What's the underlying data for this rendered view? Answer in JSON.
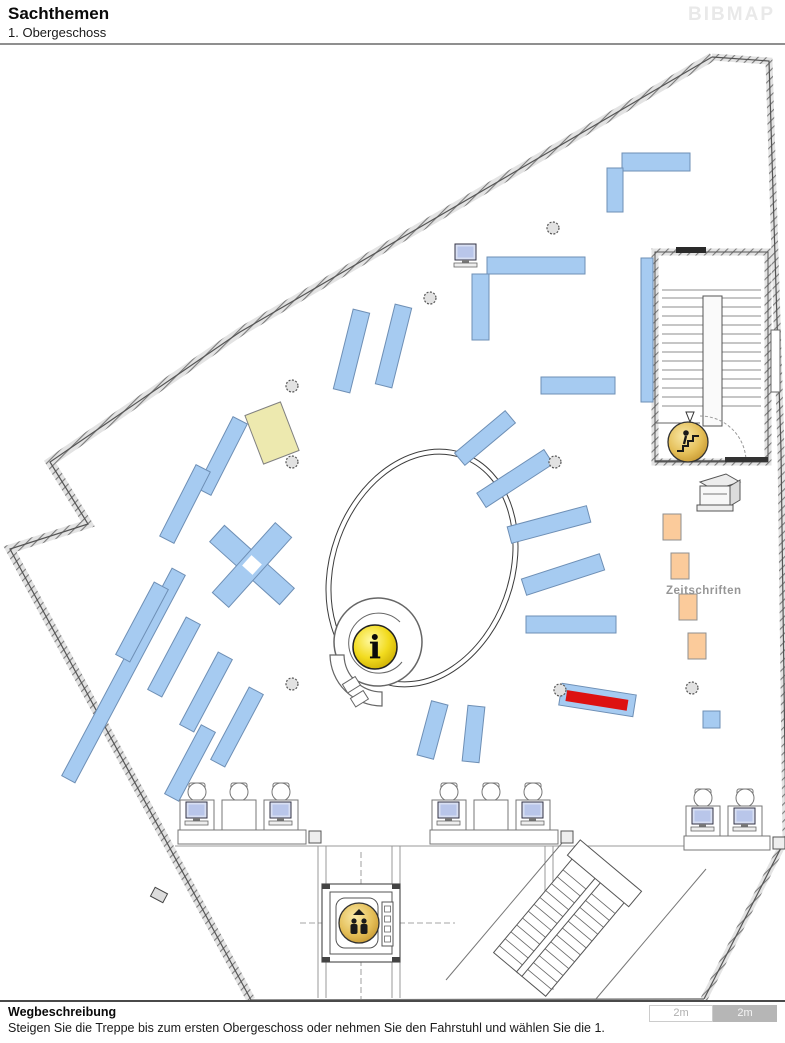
{
  "header": {
    "title": "Sachthemen",
    "subtitle": "1. Obergeschoss",
    "logo": "BIBMAP"
  },
  "footer": {
    "heading": "Wegbeschreibung",
    "instruction": "Steigen Sie die Treppe bis zum ersten Obergeschoss oder nehmen Sie den Fahrstuhl und wählen Sie die 1.",
    "scale_labels": [
      "2m",
      "2m"
    ]
  },
  "map": {
    "area_label": {
      "text": "Zeitschriften",
      "x": 666,
      "y": 594
    },
    "colors": {
      "shelf_fill": "#A6CBF1",
      "shelf_border": "#6E8FB5",
      "magazine_fill": "#FBCB9B",
      "magazine_border": "#8f8f8f",
      "special_fill": "#EDE9AF",
      "special_border": "#808080",
      "highlight": "#DD1111",
      "label_gray": "#969696"
    },
    "shelves": [
      {
        "x": 622,
        "y": 153,
        "w": 68,
        "h": 18,
        "rot": 0
      },
      {
        "x": 607,
        "y": 168,
        "w": 16,
        "h": 44,
        "rot": 0
      },
      {
        "x": 487,
        "y": 257,
        "w": 98,
        "h": 17,
        "rot": 0
      },
      {
        "x": 472,
        "y": 274,
        "w": 17,
        "h": 66,
        "rot": 0
      },
      {
        "x": 641,
        "y": 258,
        "w": 12,
        "h": 144,
        "rot": 0
      },
      {
        "x": 541,
        "y": 377,
        "w": 74,
        "h": 17,
        "rot": 0
      },
      {
        "x": 526,
        "y": 616,
        "w": 90,
        "h": 17,
        "rot": 0
      },
      {
        "x": 343,
        "y": 310,
        "w": 17,
        "h": 82,
        "rot": 14
      },
      {
        "x": 385,
        "y": 305,
        "w": 17,
        "h": 82,
        "rot": 14
      },
      {
        "x": 452,
        "y": 430,
        "w": 66,
        "h": 16,
        "rot": -40
      },
      {
        "x": 475,
        "y": 470,
        "w": 80,
        "h": 17,
        "rot": -33
      },
      {
        "x": 508,
        "y": 516,
        "w": 82,
        "h": 17,
        "rot": -15
      },
      {
        "x": 522,
        "y": 566,
        "w": 82,
        "h": 17,
        "rot": -18
      },
      {
        "x": 424,
        "y": 702,
        "w": 17,
        "h": 56,
        "rot": 15
      },
      {
        "x": 465,
        "y": 706,
        "w": 17,
        "h": 56,
        "rot": 6
      },
      {
        "x": 214,
        "y": 416,
        "w": 16,
        "h": 80,
        "rot": 27
      },
      {
        "x": 177,
        "y": 464,
        "w": 16,
        "h": 80,
        "rot": 27
      },
      {
        "x": 116,
        "y": 558,
        "w": 15,
        "h": 235,
        "rot": 28
      },
      {
        "x": 134,
        "y": 581,
        "w": 16,
        "h": 82,
        "rot": 28
      },
      {
        "x": 166,
        "y": 616,
        "w": 16,
        "h": 82,
        "rot": 28
      },
      {
        "x": 198,
        "y": 651,
        "w": 16,
        "h": 82,
        "rot": 28
      },
      {
        "x": 229,
        "y": 686,
        "w": 16,
        "h": 82,
        "rot": 28
      },
      {
        "x": 182,
        "y": 724,
        "w": 16,
        "h": 78,
        "rot": 28
      },
      {
        "x": 703,
        "y": 711,
        "w": 17,
        "h": 17,
        "rot": 0
      }
    ],
    "cross_shelf": {
      "cx": 252,
      "cy": 565,
      "arm_l": 94,
      "arm_w": 22,
      "rot": 42
    },
    "special_shelf": {
      "x": 253,
      "y": 407,
      "w": 38,
      "h": 52,
      "rot": -21
    },
    "highlight_shelf": {
      "x": 560,
      "y": 689,
      "w": 75,
      "h": 22,
      "rot": 9,
      "inner": {
        "x": 566,
        "y": 695,
        "w": 62,
        "h": 11
      }
    },
    "magazine_size": {
      "w": 18,
      "h": 26
    },
    "magazines": [
      {
        "x": 663,
        "y": 514
      },
      {
        "x": 671,
        "y": 553
      },
      {
        "x": 679,
        "y": 594
      },
      {
        "x": 688,
        "y": 633
      }
    ],
    "columns": [
      [
        292,
        386
      ],
      [
        553,
        228
      ],
      [
        430,
        298
      ],
      [
        292,
        462
      ],
      [
        555,
        462
      ],
      [
        292,
        684
      ],
      [
        560,
        690
      ],
      [
        692,
        688
      ]
    ],
    "computers": [
      [
        455,
        244
      ]
    ],
    "desk_groups": [
      {
        "x": 180,
        "y": 800,
        "desks": 3,
        "monitors": [
          0,
          2
        ]
      },
      {
        "x": 432,
        "y": 800,
        "desks": 3,
        "monitors": [
          0,
          2
        ]
      },
      {
        "x": 686,
        "y": 806,
        "desks": 2,
        "monitors": [
          0,
          1
        ]
      }
    ],
    "icons": [
      {
        "name": "info-icon",
        "x": 375,
        "y": 647,
        "r": 22
      },
      {
        "name": "stairs-up-icon",
        "x": 688,
        "y": 442,
        "r": 20
      },
      {
        "name": "elevator-icon",
        "x": 359,
        "y": 923,
        "r": 20
      }
    ]
  }
}
